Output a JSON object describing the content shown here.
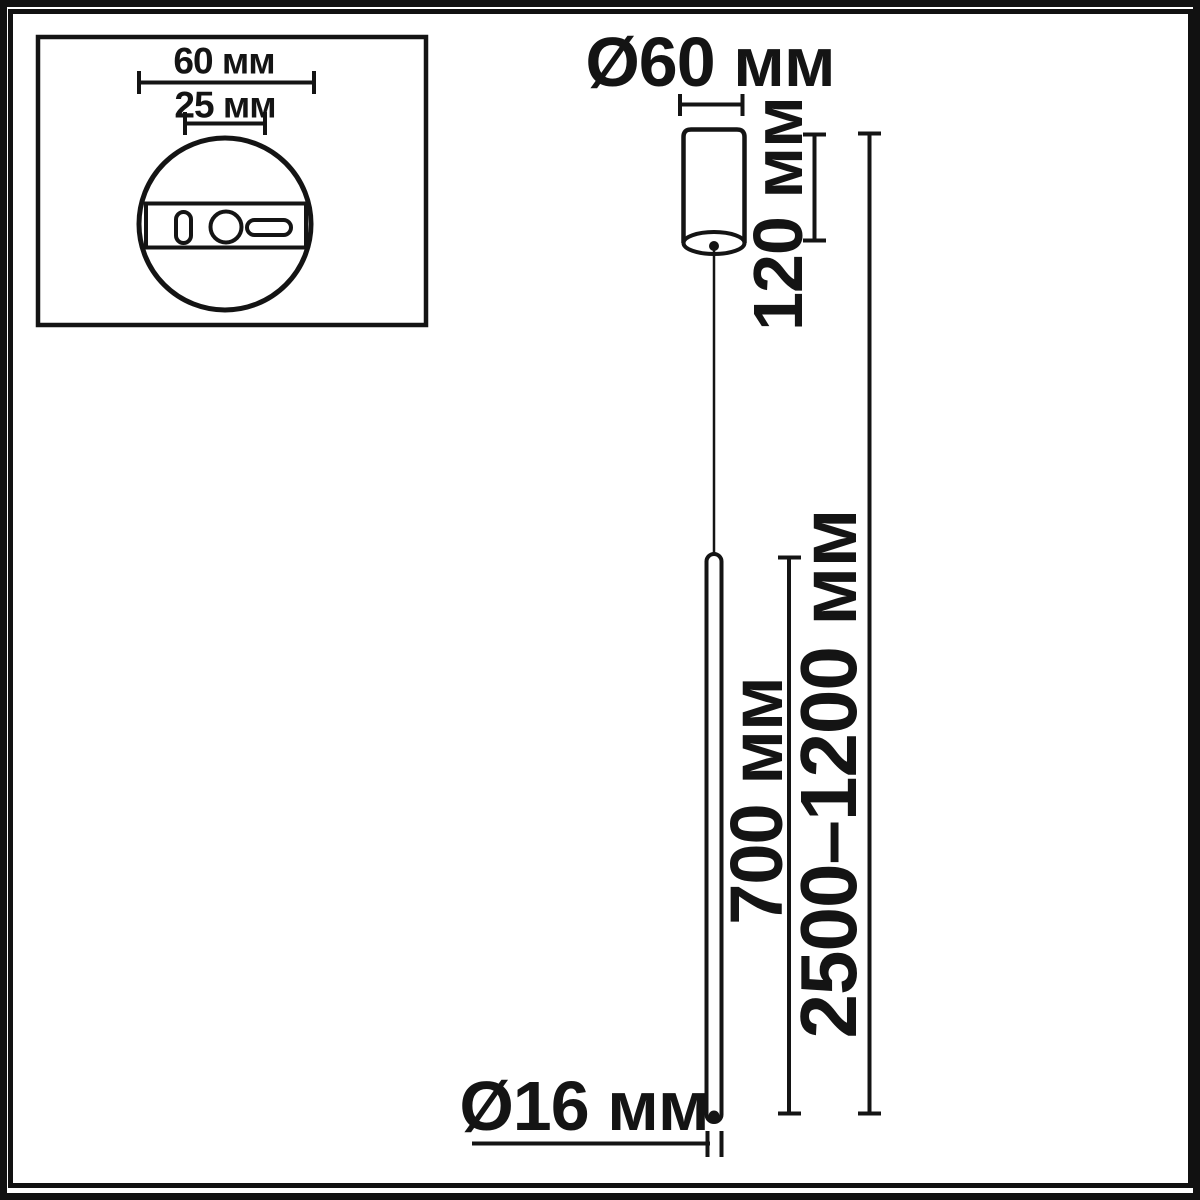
{
  "labels": {
    "inset_width": "60 мм",
    "inset_hole_spacing": "25 мм",
    "canopy_diameter": "Ø60 мм",
    "canopy_height": "120 мм",
    "rod_length": "700 мм",
    "suspension_range": "2500–1200 мм",
    "rod_diameter": "Ø16 мм"
  },
  "colors": {
    "line": "#141414",
    "background": "#ffffff"
  }
}
